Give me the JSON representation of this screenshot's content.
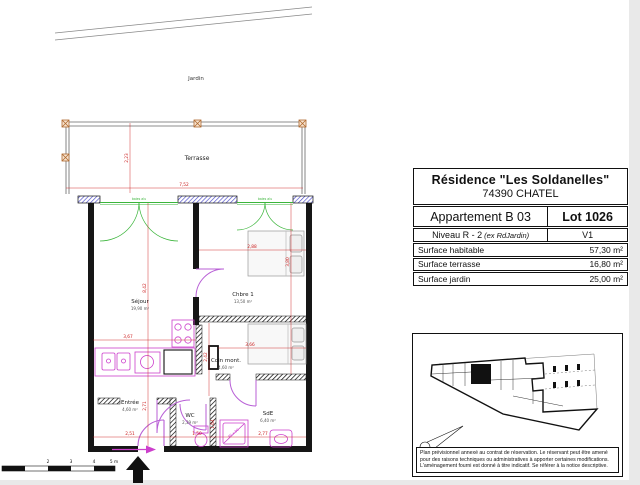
{
  "plan": {
    "jardin": "Jardin",
    "terrasse": "Terrasse",
    "window_label": "baies alu",
    "rooms": {
      "sejour": {
        "name": "Séjour",
        "area": "19,90 m²"
      },
      "chbre1": {
        "name": "Chbre 1",
        "area": "13,50 m²"
      },
      "coin": {
        "name": "Coin mont.",
        "area": "4,60 m²"
      },
      "entree": {
        "name": "Entrée",
        "area": "4,60 m²"
      },
      "wc": {
        "name": "WC",
        "area": "2,39 m²"
      },
      "sde": {
        "name": "SdE",
        "area": "6,40 m²"
      }
    },
    "dims": {
      "terrace_w": "7,52",
      "terrace_d": "2,23",
      "sejour_h": "8,42",
      "sejour_w": "3,67",
      "chbre_w": "2,88",
      "chbre_h": "3,80",
      "coin_h": "2,42",
      "coin_w": "3,66",
      "hall_h": "2,71",
      "wc_w": "1,50",
      "wc_h": "1,64",
      "sde_w": "2,77",
      "entree_w": "2,51",
      "shower": "90 x 90"
    },
    "scalebar": [
      "2",
      "3",
      "4",
      "5 m"
    ]
  },
  "info_table": {
    "title": "Résidence \"Les Soldanelles\"",
    "city": "74390 CHATEL",
    "apartment": "Appartement B 03",
    "lot": "Lot 1026",
    "level": "Niveau R - 2",
    "level_note": "(ex RdJardin)",
    "version": "V1",
    "surfaces": [
      {
        "label": "Surface habitable",
        "value": "57,30 m²"
      },
      {
        "label": "Surface terrasse",
        "value": "16,80 m²"
      },
      {
        "label": "Surface jardin",
        "value": "25,00 m²"
      }
    ]
  },
  "site_plan": {
    "disclaimer": "Plan prévisionnel annexé au contrat de réservation. Le réservant peut être amené pour des raisons techniques ou administratives à apporter certaines modifications. L'aménagement fourni est donné à titre indicatif. Se référer à la notice descriptive."
  },
  "colors": {
    "dimension": "#cc2020",
    "opening": "#3bb53b",
    "fixture": "#cc3fcc",
    "door": "#b85fd6",
    "pier_hatch": "#4848c8"
  }
}
